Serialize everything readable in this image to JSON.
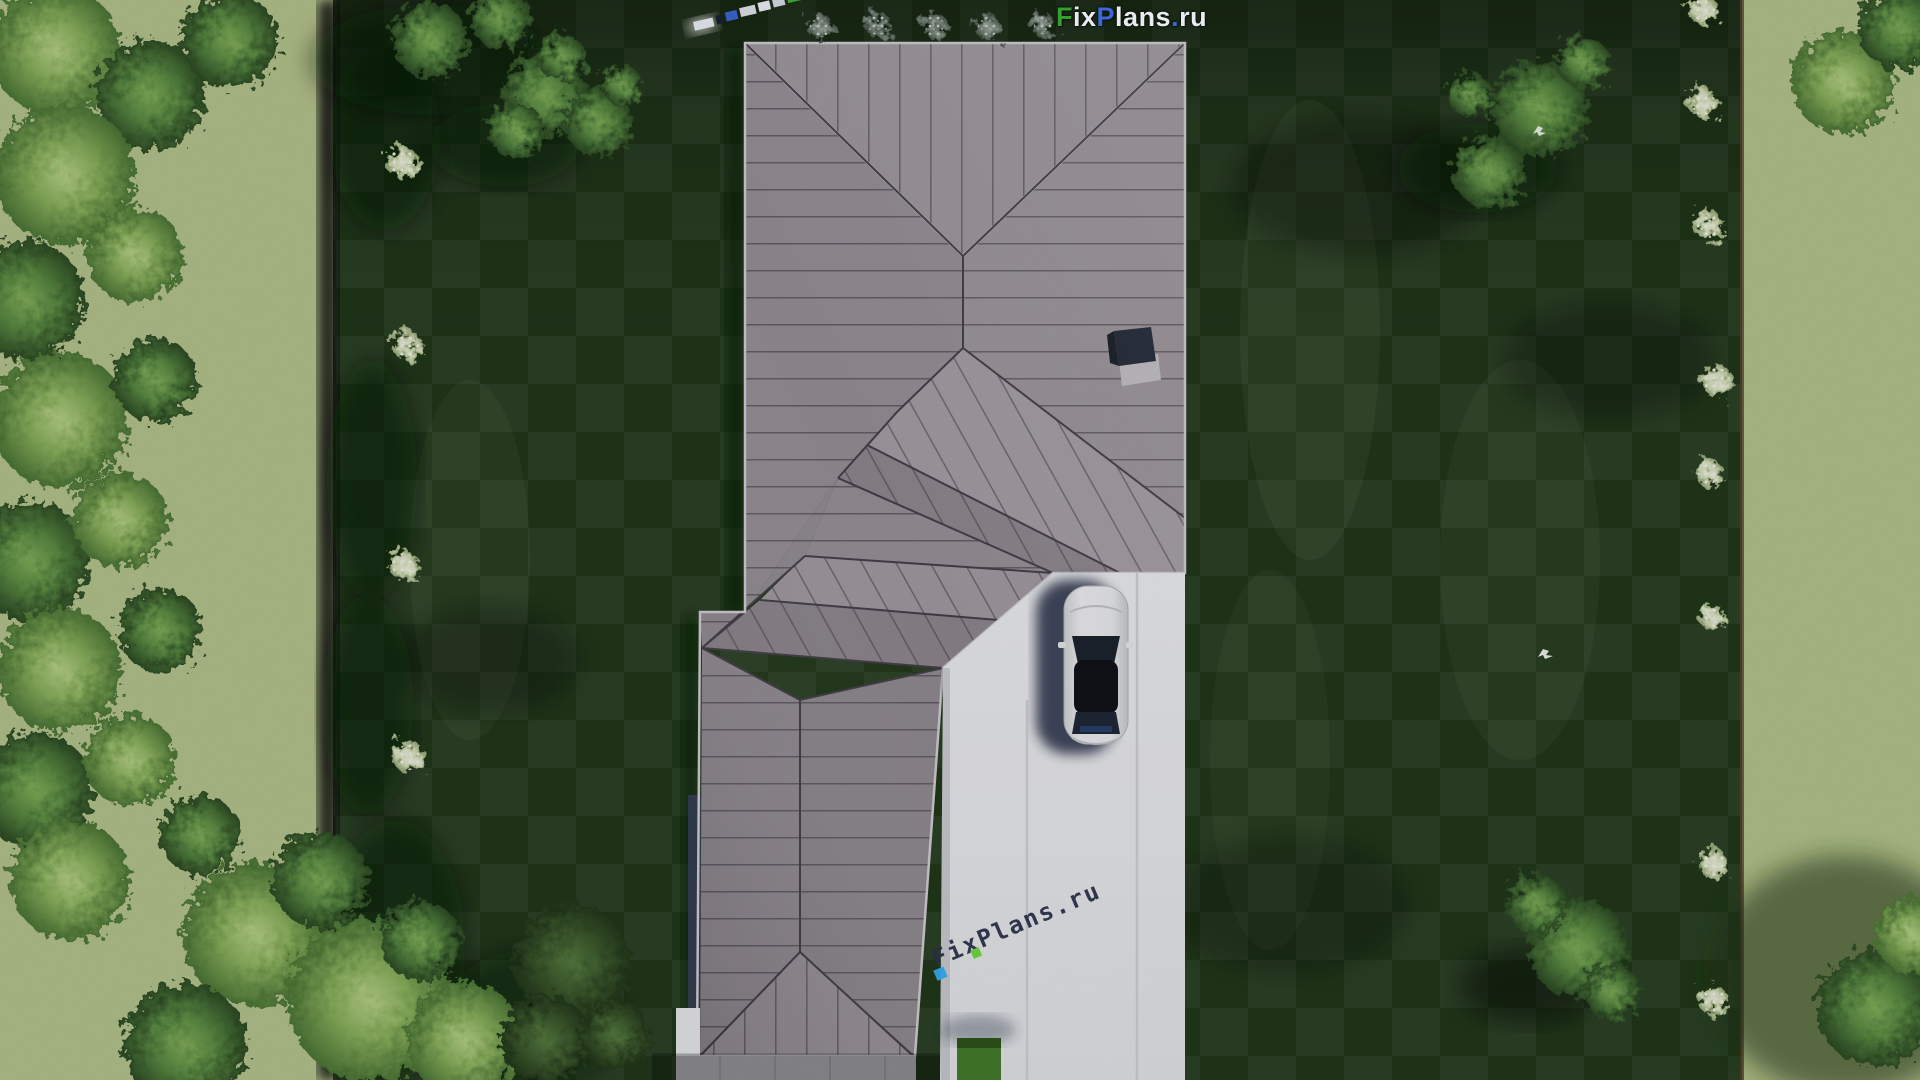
{
  "watermark_top": {
    "segments": [
      {
        "text": "F",
        "color": "#35a02f"
      },
      {
        "text": "ix",
        "color": "#e9eaf2"
      },
      {
        "text": "P",
        "color": "#3e66d8"
      },
      {
        "text": "lans",
        "color": "#e9eaf2"
      },
      {
        "text": ".",
        "color": "#3e66d8"
      },
      {
        "text": "ru",
        "color": "#e9eaf2"
      }
    ]
  },
  "watermark_diagonal": {
    "text": "FixPlans.ru",
    "color": "#272e45",
    "accent_blue": "#2f9fe0",
    "accent_green": "#5fc433",
    "rotation_deg": -23
  },
  "scene": {
    "type": "aerial-3d-site-plan-render",
    "house": {
      "roof_color": "#9c959c",
      "seam_color": "#46404a",
      "chimney_color": "#222a39"
    },
    "driveway": {
      "color": "#eff1f4",
      "joint_color": "#d5d8dc",
      "grass_inset_color": "#46802c"
    },
    "car": {
      "body_color": "#f4f4f6",
      "glass_color": "#161a22",
      "shadow_color": "#262e47"
    },
    "lawn": {
      "color": "#223a1b",
      "checker_light": "#2b4423"
    },
    "surrounding_grass": {
      "color": "#a7ba74"
    },
    "vegetation": {
      "tree_color": "#5d8f45",
      "tree_bright_color": "#8db55f",
      "flower_bush_color": "#edf2dc",
      "gray_bush_color": "#707f72"
    },
    "patio": {
      "color": "#c5c3c9"
    }
  }
}
